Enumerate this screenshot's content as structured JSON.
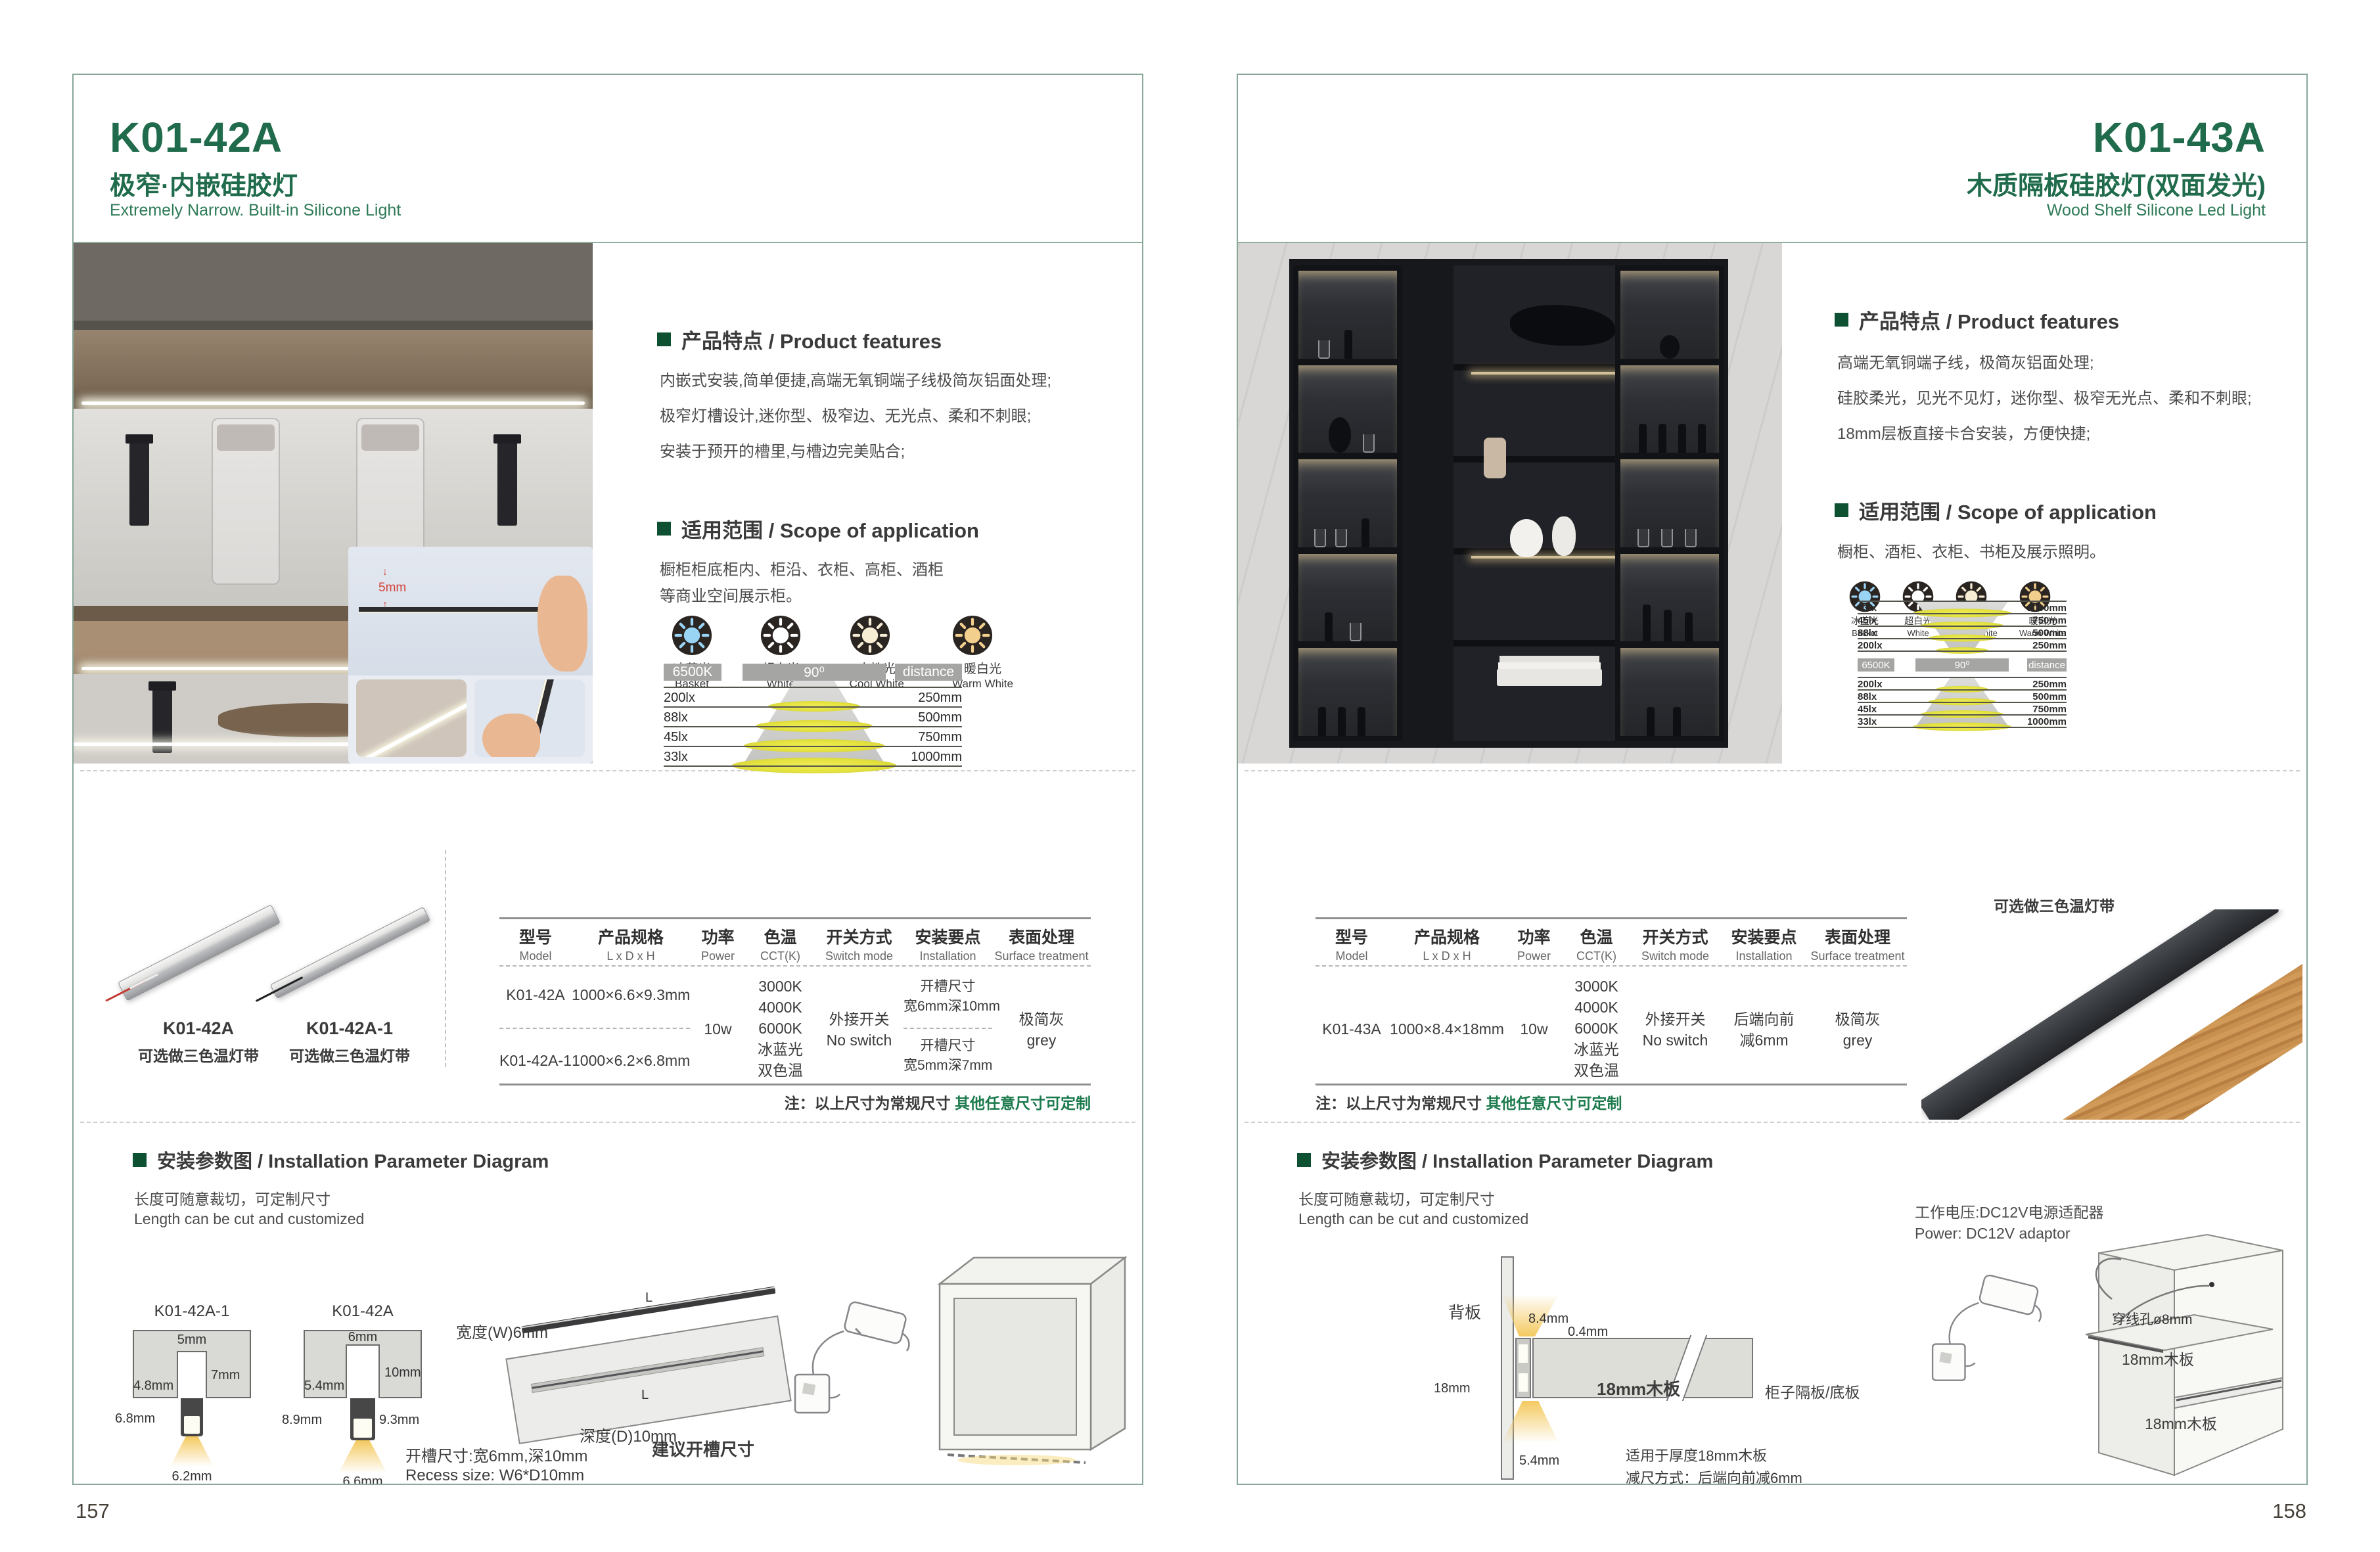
{
  "p157": {
    "page_number": "157",
    "model": "K01-42A",
    "title_cn": "极窄·内嵌硅胶灯",
    "title_en": "Extremely Narrow. Built-in Silicone Light",
    "features_heading": "产品特点 / Product features",
    "feature_lines": [
      "内嵌式安装,简单便捷,高端无氧铜端子线极简灰铝面处理;",
      "极窄灯槽设计,迷你型、极窄边、无光点、柔和不刺眼;",
      "安装于预开的槽里,与槽边完美贴合;"
    ],
    "scope_heading": "适用范围 / Scope of application",
    "scope_lines": [
      "橱柜柜底柜内、柜沿、衣柜、高柜、酒柜",
      "等商业空间展示柜。"
    ],
    "photo_dim": "5mm",
    "light_colors": [
      {
        "cn": "冰蓝光",
        "en": "Basket",
        "color": "#9ad4f5"
      },
      {
        "cn": "超白光",
        "en": "White",
        "color": "#ffffff"
      },
      {
        "cn": "中性光",
        "en": "Cool White",
        "color": "#f6ecd4"
      },
      {
        "cn": "暖白光",
        "en": "Warm White",
        "color": "#f2cf8d"
      }
    ],
    "photometric": {
      "cct": "6500K",
      "beam": "90⁰",
      "distance_label": "distance",
      "rows": [
        {
          "lux": "200lx",
          "distance": "250mm"
        },
        {
          "lux": "88lx",
          "distance": "500mm"
        },
        {
          "lux": "45lx",
          "distance": "750mm"
        },
        {
          "lux": "33lx",
          "distance": "1000mm"
        }
      ]
    },
    "products": [
      {
        "name": "K01-42A",
        "note": "可选做三色温灯带"
      },
      {
        "name": "K01-42A-1",
        "note": "可选做三色温灯带"
      }
    ],
    "table": {
      "headers": [
        {
          "cn": "型号",
          "en": "Model"
        },
        {
          "cn": "产品规格",
          "en": "L x D x H"
        },
        {
          "cn": "功率",
          "en": "Power"
        },
        {
          "cn": "色温",
          "en": "CCT(K)"
        },
        {
          "cn": "开关方式",
          "en": "Switch mode"
        },
        {
          "cn": "安装要点",
          "en": "Installation"
        },
        {
          "cn": "表面处理",
          "en": "Surface treatment"
        }
      ],
      "rows": [
        {
          "model": "K01-42A",
          "spec": "1000×6.6×9.3mm"
        },
        {
          "model": "K01-42A-1",
          "spec": "1000×6.2×6.8mm"
        }
      ],
      "power": "10w",
      "cct": [
        "3000K",
        "4000K",
        "6000K",
        "冰蓝光",
        "双色温"
      ],
      "switch": [
        "外接开关",
        "No switch"
      ],
      "install": [
        [
          "开槽尺寸",
          "宽6mm深10mm"
        ],
        [
          "开槽尺寸",
          "宽5mm深7mm"
        ]
      ],
      "surface": [
        "极简灰",
        "grey"
      ]
    },
    "note_label": "注：以上尺寸为常规尺寸",
    "note_custom": "其他任意尺寸可定制",
    "install_heading": "安装参数图 / Installation Parameter Diagram",
    "cut_cn": "长度可随意裁切，可定制尺寸",
    "cut_en": "Length can be cut and customized",
    "diagrams": {
      "a": {
        "label": "K01-42A-1",
        "top": "5mm",
        "depth": "7mm",
        "inner": "4.8mm",
        "height": "6.8mm",
        "bottom": "6.2mm"
      },
      "b": {
        "label": "K01-42A",
        "top": "6mm",
        "depth": "10mm",
        "inner": "5.4mm",
        "height_l": "8.9mm",
        "height_r": "9.3mm",
        "bottom": "6.6mm"
      },
      "board": {
        "width": "宽度(W)6mm",
        "depth": "深度(D)10mm",
        "suggest": "建议开槽尺寸",
        "len": "L"
      },
      "recess_cn": "开槽尺寸:宽6mm,深10mm",
      "recess_en": "Recess size: W6*D10mm"
    }
  },
  "p158": {
    "page_number": "158",
    "model": "K01-43A",
    "title_cn": "木质隔板硅胶灯(双面发光)",
    "title_en": "Wood Shelf Silicone Led Light",
    "features_heading": "产品特点 / Product features",
    "feature_lines": [
      "高端无氧铜端子线，极简灰铝面处理;",
      "硅胶柔光，见光不见灯，迷你型、极窄无光点、柔和不刺眼;",
      "18mm层板直接卡合安装，方便快捷;"
    ],
    "scope_heading": "适用范围 / Scope of application",
    "scope_lines": [
      "橱柜、酒柜、衣柜、书柜及展示照明。"
    ],
    "light_colors": [
      {
        "cn": "冰蓝光",
        "en": "Basket",
        "color": "#9ad4f5"
      },
      {
        "cn": "超白光",
        "en": "White",
        "color": "#ffffff"
      },
      {
        "cn": "中性光",
        "en": "Cool White",
        "color": "#f6ecd4"
      },
      {
        "cn": "暖白光",
        "en": "Warm White",
        "color": "#f2cf8d"
      }
    ],
    "photometric": {
      "cct": "6500K",
      "beam": "90⁰",
      "distance_label": "distance",
      "top_rows": [
        {
          "lux": "33lx",
          "distance": "1000mm"
        },
        {
          "lux": "45lx",
          "distance": "750mm"
        },
        {
          "lux": "88lx",
          "distance": "500mm"
        },
        {
          "lux": "200lx",
          "distance": "250mm"
        }
      ],
      "bottom_rows": [
        {
          "lux": "200lx",
          "distance": "250mm"
        },
        {
          "lux": "88lx",
          "distance": "500mm"
        },
        {
          "lux": "45lx",
          "distance": "750mm"
        },
        {
          "lux": "33lx",
          "distance": "1000mm"
        }
      ]
    },
    "product_note": "可选做三色温灯带",
    "table": {
      "headers": [
        {
          "cn": "型号",
          "en": "Model"
        },
        {
          "cn": "产品规格",
          "en": "L x D x H"
        },
        {
          "cn": "功率",
          "en": "Power"
        },
        {
          "cn": "色温",
          "en": "CCT(K)"
        },
        {
          "cn": "开关方式",
          "en": "Switch mode"
        },
        {
          "cn": "安装要点",
          "en": "Installation"
        },
        {
          "cn": "表面处理",
          "en": "Surface treatment"
        }
      ],
      "row": {
        "model": "K01-43A",
        "spec": "1000×8.4×18mm",
        "power": "10w",
        "cct": [
          "3000K",
          "4000K",
          "6000K",
          "冰蓝光",
          "双色温"
        ],
        "switch": [
          "外接开关",
          "No switch"
        ],
        "install": [
          "后端向前",
          "减6mm"
        ],
        "surface": [
          "极简灰",
          "grey"
        ]
      }
    },
    "note_label": "注：以上尺寸为常规尺寸",
    "note_custom": "其他任意尺寸可定制",
    "install_heading": "安装参数图 / Installation Parameter Diagram",
    "cut_cn": "长度可随意裁切，可定制尺寸",
    "cut_en": "Length can be cut and customized",
    "cross_section": {
      "back": "背板",
      "d_top": "8.4mm",
      "d_gap": "0.4mm",
      "d_thick": "18mm",
      "board": "18mm木板",
      "side": "柜子隔板/底板",
      "d_bottom": "5.4mm",
      "note1": "适用于厚度18mm木板",
      "note2": "减尺方式：后端向前减6mm"
    },
    "power_cn": "工作电压:DC12V电源适配器",
    "power_en": "Power: DC12V adaptor",
    "cabinet": {
      "hole": "穿线孔ø8mm",
      "board1": "18mm木板",
      "board2": "18mm木板"
    }
  }
}
